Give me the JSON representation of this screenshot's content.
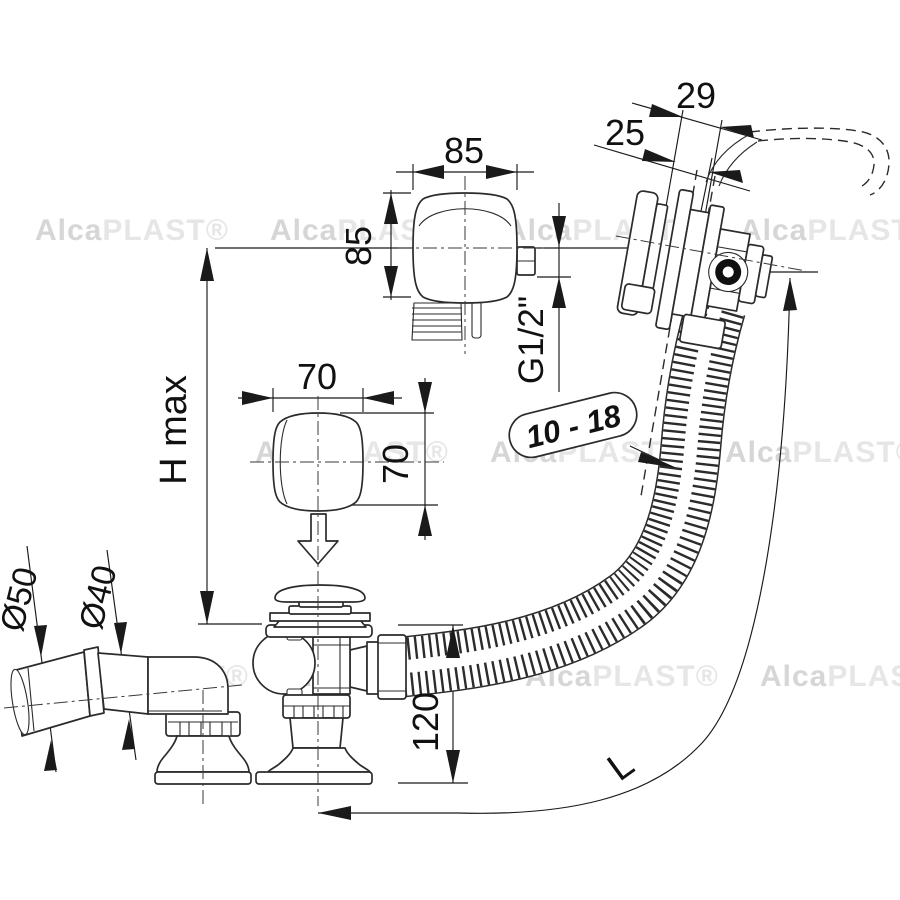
{
  "diagram": {
    "title": "Bath waste and overflow set - dimensional drawing",
    "dims": {
      "box_width": "85",
      "box_height": "85",
      "thread": "G1/2\"",
      "knob_width": "70",
      "knob_height": "70",
      "edge_offset_outer": "29",
      "edge_offset_inner": "25",
      "wall_thickness_range": "10 - 18",
      "height_max": "H max",
      "outlet_d50": "Ø50",
      "outlet_d40": "Ø40",
      "drain_height": "120",
      "hose_length": "L"
    },
    "watermark": {
      "bold": "Alca",
      "light": "PLAST",
      "reg": "®"
    },
    "colors": {
      "line": "#2b2b2b",
      "dim_text": "#111111",
      "watermark_bold": "#d6d6d6",
      "watermark_light": "#e6e6e6",
      "oring": "#101010",
      "background": "#ffffff"
    }
  }
}
